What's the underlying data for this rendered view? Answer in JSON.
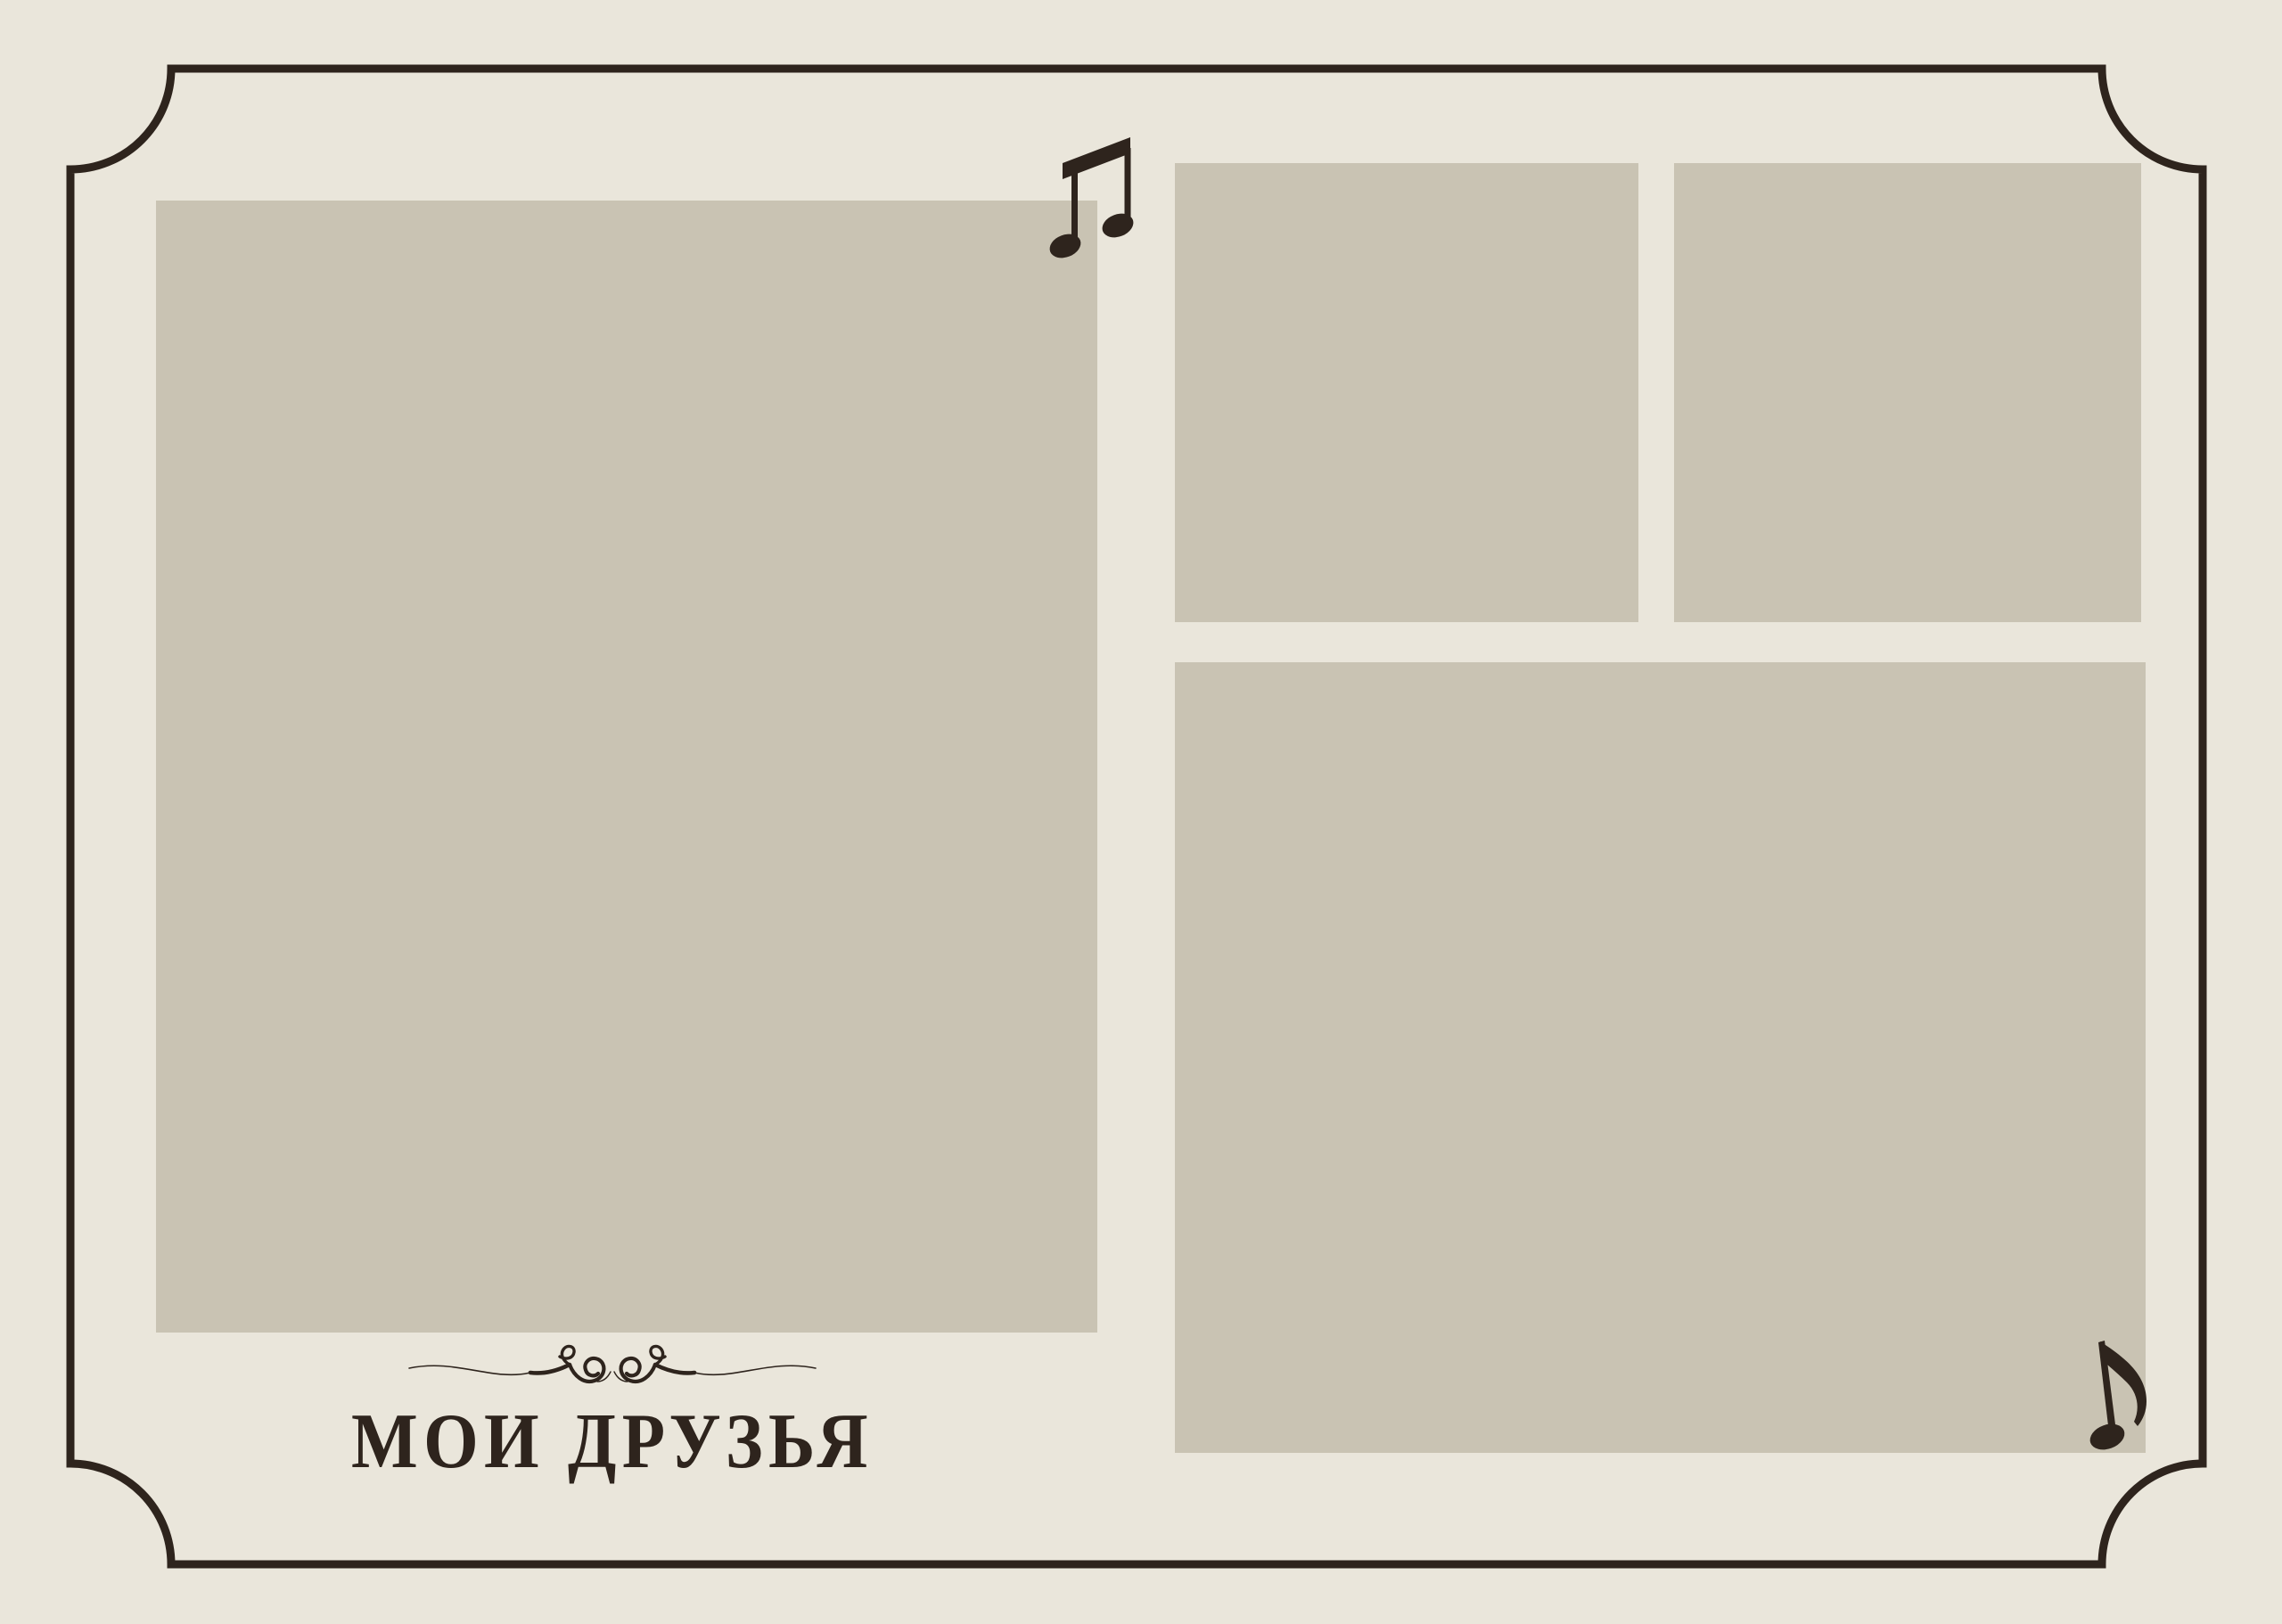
{
  "page": {
    "title": "МОИ ДРУЗЬЯ"
  },
  "colors": {
    "background": "#EAE6DB",
    "placeholder": "#C9C3B3",
    "ink": "#2E241D",
    "frame": "#2E241D"
  },
  "photo_slots": [
    {
      "id": "left-large"
    },
    {
      "id": "top-middle"
    },
    {
      "id": "top-right"
    },
    {
      "id": "bottom-right-large"
    }
  ],
  "decorations": {
    "top_note": "beamed-eighth-notes",
    "bottom_note": "single-eighth-note",
    "divider": "swirl-flourish",
    "frame": "scooped-corner-border"
  }
}
